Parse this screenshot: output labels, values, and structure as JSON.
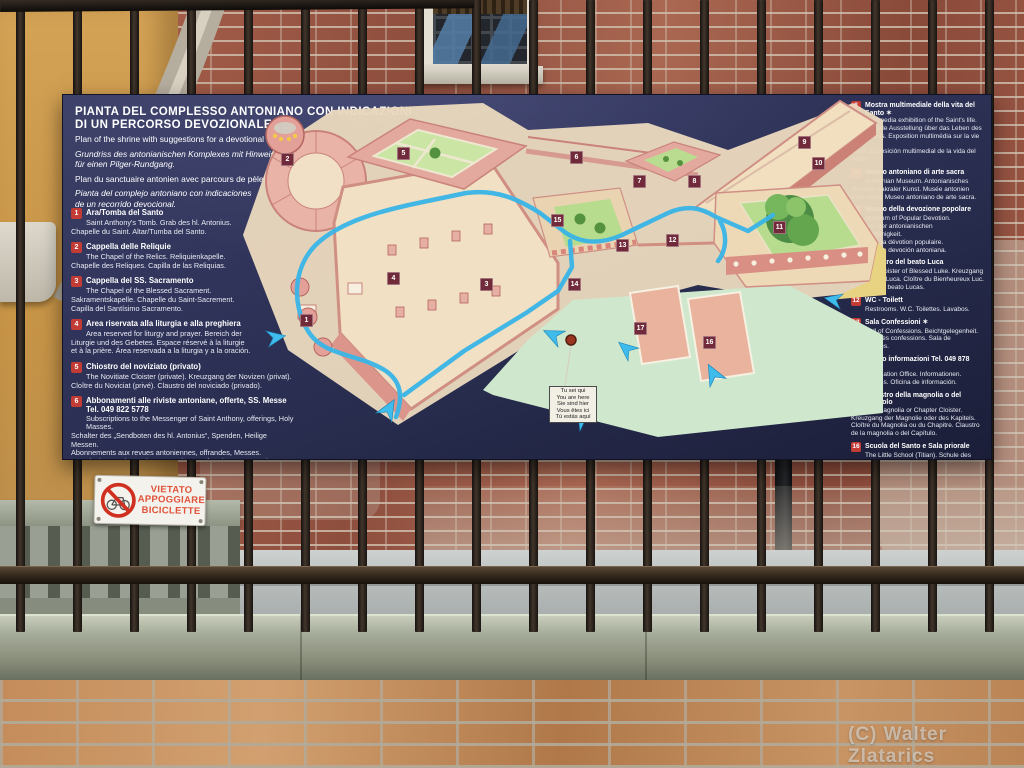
{
  "photo": {
    "watermark": "(C) Walter Zlatarics"
  },
  "sign": {
    "title_line1": "PIANTA DEL COMPLESSO ANTONIANO CON INDICAZIONI",
    "title_line2": "DI UN PERCORSO DEVOZIONALE",
    "accent_color": "#49b8e8",
    "panel_color": "#2e3254",
    "subtitles": [
      "Plan of the shrine with suggestions for a devotional itinerary.",
      "Grundriss des antonianischen Komplexes mit Hinweisen",
      "für einen Pilger-Rundgang.",
      "Plan du sanctuaire antonien avec parcours de pèlerinage.",
      "Pianta del complejo antoniano con indicaciones",
      "de un recorrido devocional."
    ]
  },
  "legend_left": {
    "items": [
      {
        "num": "1",
        "title": "Ara/Tomba del Santo",
        "lines": [
          "Saint Anthony's Tomb. Grab des hl. Antonius.",
          "Chapelle du Saint. Altar/Tumba del Santo."
        ]
      },
      {
        "num": "2",
        "title": "Cappella delle Reliquie",
        "lines": [
          "The Chapel of the Relics. Reliquienkapelle.",
          "Chapelle des Reliques. Capilla de las Reliquias."
        ]
      },
      {
        "num": "3",
        "title": "Cappella del SS. Sacramento",
        "lines": [
          "The Chapel of the Blessed Sacrament.",
          "Sakramentskapelle. Chapelle du Saint-Sacrement.",
          "Capilla del Santísimo Sacramento."
        ]
      },
      {
        "num": "4",
        "title": "Area riservata alla liturgia e alla preghiera",
        "lines": [
          "Area reserved for liturgy and prayer. Bereich der",
          "Liturgie und des Gebetes. Espace réservé à la liturgie",
          "et à la prière. Área reservada a la liturgia y a la oración."
        ]
      },
      {
        "num": "5",
        "title": "Chiostro del noviziato (privato)",
        "lines": [
          "The Novitiate Cloister (private). Kreuzgang der Novizen (privat).",
          "Cloître du Noviciat (privé). Claustro del noviciado (privado)."
        ]
      },
      {
        "num": "6",
        "title": "Abbonamenti alle riviste antoniane, offerte, SS. Messe   Tel. 049 822 5778",
        "lines": [
          "Subscriptions to the Messenger of Saint Anthony, offerings, Holy Masses.",
          "Schalter des „Sendboten des hl. Antonius“, Spenden, Heilige Messen.",
          "Abonnements aux revues antoniennes, offrandes, Messes.",
          "Suscripciones a las revistas antonianas, ofrendas, Santas Misas."
        ]
      },
      {
        "num": "7",
        "title": "Chiostro delle mostre",
        "lines": [
          "The Exhibition Cloister. Kreuzgang der Ausstellungen.",
          "Cloître des Expositions. Claustro de las exposiciones."
        ]
      }
    ]
  },
  "legend_right": {
    "items": [
      {
        "num": "8",
        "title": "Mostra multimediale della vita del Santo ✶",
        "lines": [
          "Multimedia exhibition of the Saint's life.",
          "Multimediale Ausstellung über das Leben des",
          "hl. Antonius. Exposition multimédia sur la vie du",
          "Saint. Exposición multimedial de la vida del Santo."
        ]
      },
      {
        "num": "9",
        "title": "Museo antoniano di arte sacra",
        "lines": [
          "Anthonian Museum. Antonianisches",
          "Museum sakraler Kunst. Musée antonien",
          "d'art sacré. Museo antoniano de arte sacra."
        ]
      },
      {
        "num": "10",
        "title": "Museo della devozione popolare",
        "lines": [
          "Museum of Popular Devotion.",
          "Museum der antonianischen Volksfrömmigkeit.",
          "Musée de la dévotion populaire.",
          "Museo de la devoción antoniana."
        ]
      },
      {
        "num": "11",
        "title": "Chiostro del beato Luca",
        "lines": [
          "The Cloister of Blessed Luke. Kreuzgang",
          "des seligen Luca. Cloître du Bienheureux Luc.",
          "Claustro del beato Lucas."
        ]
      },
      {
        "num": "12",
        "title": "WC - Toilett",
        "lines": [
          "Restrooms. W.C. Toilettes. Lavabos."
        ]
      },
      {
        "num": "13",
        "title": "Sala Confessioni ✶",
        "lines": [
          "Hall of Confessions. Beichtgelegenheit.",
          "Chapelle des confessions. Sala de Confesiones."
        ]
      },
      {
        "num": "14",
        "title": "Ufficio informazioni   Tel. 049 878 9722",
        "lines": [
          "Information Office. Informationen.",
          "Informations. Oficina de información."
        ]
      },
      {
        "num": "15",
        "title": "Chiostro della magnolia o del Capitolo",
        "lines": [
          "The Magnolia or Chapter Cloister.",
          "Kreuzgang der Magnolie oder des Kapitels.",
          "Cloître du Magnolia ou du Chapitre. Claustro",
          "de la magnolia o del Capítulo."
        ]
      },
      {
        "num": "16",
        "title": "Scuola del Santo e Sala priorale",
        "lines": [
          "The Little School (Titian). Schule des",
          "hl. Antonius. École de saint Antoine.",
          "Escuela del Santo."
        ]
      },
      {
        "num": "17",
        "title": "Oratorio di S. Giorgio",
        "lines": [
          "The Oratory of St. George. Oratorium",
          "des hl. Georg. Oratoire Saint-Georges.",
          "Oratorio de San Jorge."
        ]
      }
    ]
  },
  "map": {
    "marker_color": "#702a3a",
    "route_color": "#39b5e7",
    "markers": [
      {
        "n": "1",
        "x": 78,
        "y": 225
      },
      {
        "n": "2",
        "x": 59,
        "y": 64
      },
      {
        "n": "3",
        "x": 258,
        "y": 189
      },
      {
        "n": "4",
        "x": 165,
        "y": 183
      },
      {
        "n": "5",
        "x": 175,
        "y": 58
      },
      {
        "n": "6",
        "x": 348,
        "y": 62
      },
      {
        "n": "7",
        "x": 411,
        "y": 86
      },
      {
        "n": "8",
        "x": 466,
        "y": 86
      },
      {
        "n": "9",
        "x": 576,
        "y": 47
      },
      {
        "n": "10",
        "x": 590,
        "y": 68
      },
      {
        "n": "11",
        "x": 551,
        "y": 132
      },
      {
        "n": "12",
        "x": 444,
        "y": 145
      },
      {
        "n": "13",
        "x": 394,
        "y": 150
      },
      {
        "n": "14",
        "x": 346,
        "y": 189
      },
      {
        "n": "15",
        "x": 329,
        "y": 125
      },
      {
        "n": "16",
        "x": 481,
        "y": 247
      },
      {
        "n": "17",
        "x": 412,
        "y": 233
      }
    ],
    "you_are_here": {
      "lines": [
        "Tu sei qui",
        "You are here",
        "Sie sind hier",
        "Vous êtes ici",
        "Tú estás aquí"
      ]
    }
  },
  "vietato_sign": {
    "lines": [
      "VIETATO",
      "APPOGGIARE",
      "BICICLETTE"
    ]
  }
}
